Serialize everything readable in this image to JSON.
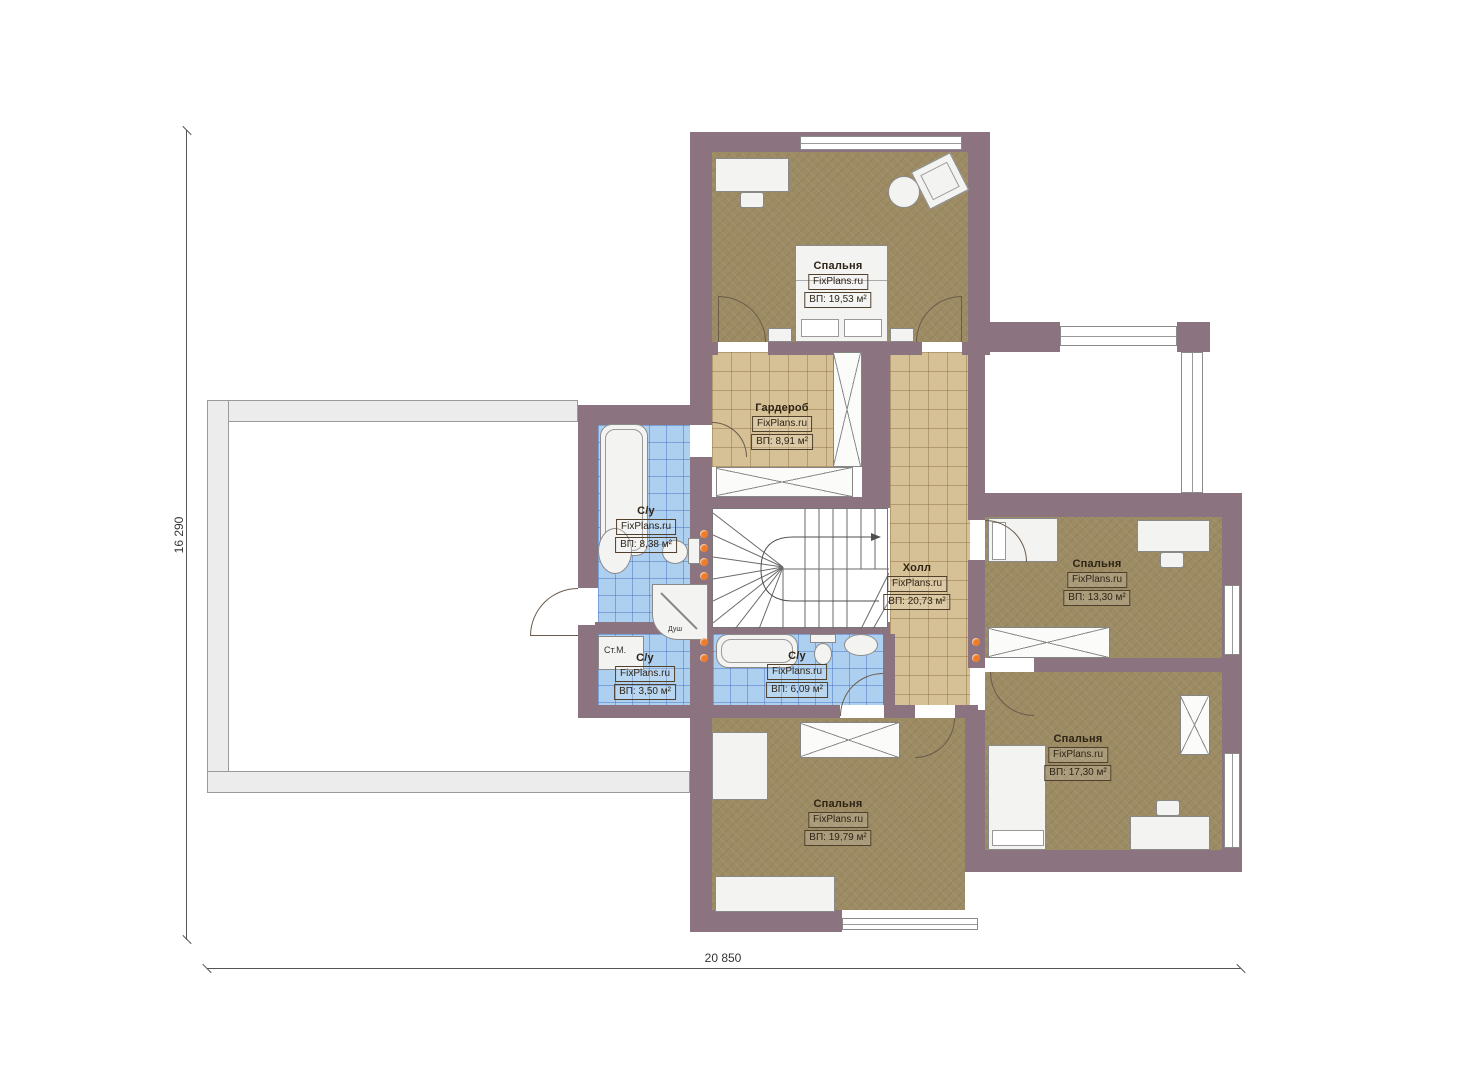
{
  "brand": "FixPlans.ru",
  "plan": {
    "floor_type": "second-floor-plan"
  },
  "dimensions": {
    "width_label": "20 850",
    "height_label": "16 290"
  },
  "rooms": [
    {
      "id": "bedroom-top",
      "name": "Спальня",
      "brand": "FixPlans.ru",
      "area": "ВП: 19,53 м²"
    },
    {
      "id": "wardrobe",
      "name": "Гардероб",
      "brand": "FixPlans.ru",
      "area": "ВП: 8,91 м²"
    },
    {
      "id": "bathroom-left",
      "name": "С/у",
      "brand": "FixPlans.ru",
      "area": "ВП: 8,38 м²"
    },
    {
      "id": "hall",
      "name": "Холл",
      "brand": "FixPlans.ru",
      "area": "ВП: 20,73 м²"
    },
    {
      "id": "bedroom-right",
      "name": "Спальня",
      "brand": "FixPlans.ru",
      "area": "ВП: 13,30 м²"
    },
    {
      "id": "bathroom-small",
      "name": "С/у",
      "brand": "FixPlans.ru",
      "area": "ВП: 3,50 м²"
    },
    {
      "id": "bathroom-middle",
      "name": "С/у",
      "brand": "FixPlans.ru",
      "area": "ВП: 6,09 м²"
    },
    {
      "id": "bedroom-bottom-right",
      "name": "Спальня",
      "brand": "FixPlans.ru",
      "area": "ВП: 17,30 м²"
    },
    {
      "id": "bedroom-bottom",
      "name": "Спальня",
      "brand": "FixPlans.ru",
      "area": "ВП: 19,79 м²"
    }
  ],
  "annotations": {
    "washing_machine": "Ст.М.",
    "shower": "Душ"
  },
  "colors": {
    "wall": "#8b7480",
    "bedroom": "#9c8b63",
    "tan": "#d6c096",
    "blue": "#aed0f0",
    "accent": "#ed7d2b",
    "furn": "#f3f3f2",
    "terrace": "#ececec"
  }
}
